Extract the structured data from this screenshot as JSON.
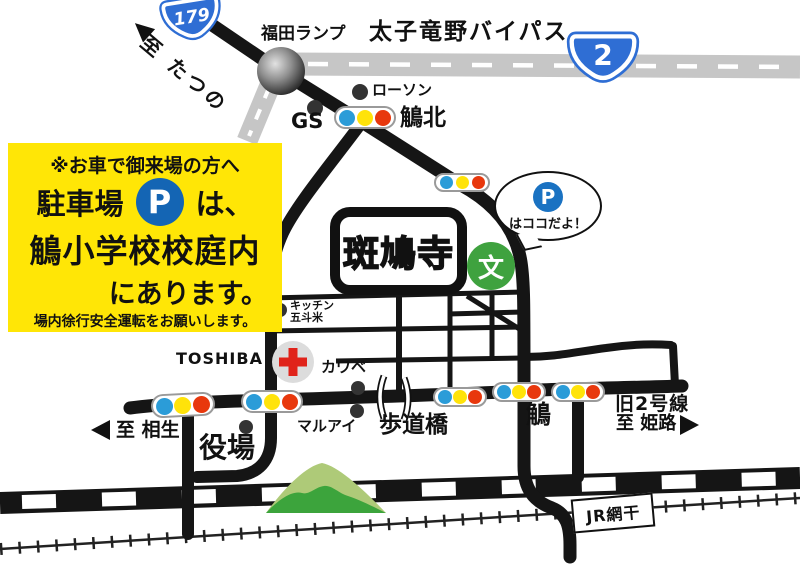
{
  "notice_box": {
    "line1": "※お車で御来場の方へ",
    "line2_pre": "駐車場",
    "parking_symbol": "P",
    "line2_post": "は、",
    "line3": "鵤小学校校庭内",
    "line4": "にあります。",
    "line5": "場内徐行安全運転をお願いします。"
  },
  "shields": {
    "route179": "179",
    "route2": "2"
  },
  "balloon": {
    "p": "P",
    "text": "はココだよ！"
  },
  "labels": {
    "to_tatsuno": "至 たつの",
    "fukuda_ramp": "福田ランプ",
    "bypass": "太子竜野バイパス",
    "lawson": "ローソン",
    "gs": "GS",
    "ikaruga_kita": "鵤北",
    "temple": "斑鳩寺",
    "school_mark": "文",
    "kitchen_line1": "キッチン",
    "kitchen_line2": "五斗米",
    "toshiba": "TOSHIBA",
    "kawabe": "カワベ",
    "maruai": "マルアイ",
    "pedestrian_bridge": "歩道橋",
    "town_office": "役場",
    "to_aioi": "至 相生",
    "ikaruga": "鵤",
    "old_route2": "旧2号線",
    "to_himeji": "至 姫路",
    "jr_aboshi": "JR網干"
  },
  "colors": {
    "notice_bg": "#ffe606",
    "parking_blue": "#1465b4",
    "shield_blue": "#2f6ed4",
    "signal_blue": "#2b9cd8",
    "signal_yellow": "#ffe30a",
    "signal_red": "#e8380d",
    "school_green": "#3fa23f",
    "mountain_light": "#aeca78",
    "mountain_dark": "#3ca43c",
    "hospital_red": "#e0231a",
    "road_black": "#151515",
    "bypass_gray": "#c6c6c6"
  }
}
